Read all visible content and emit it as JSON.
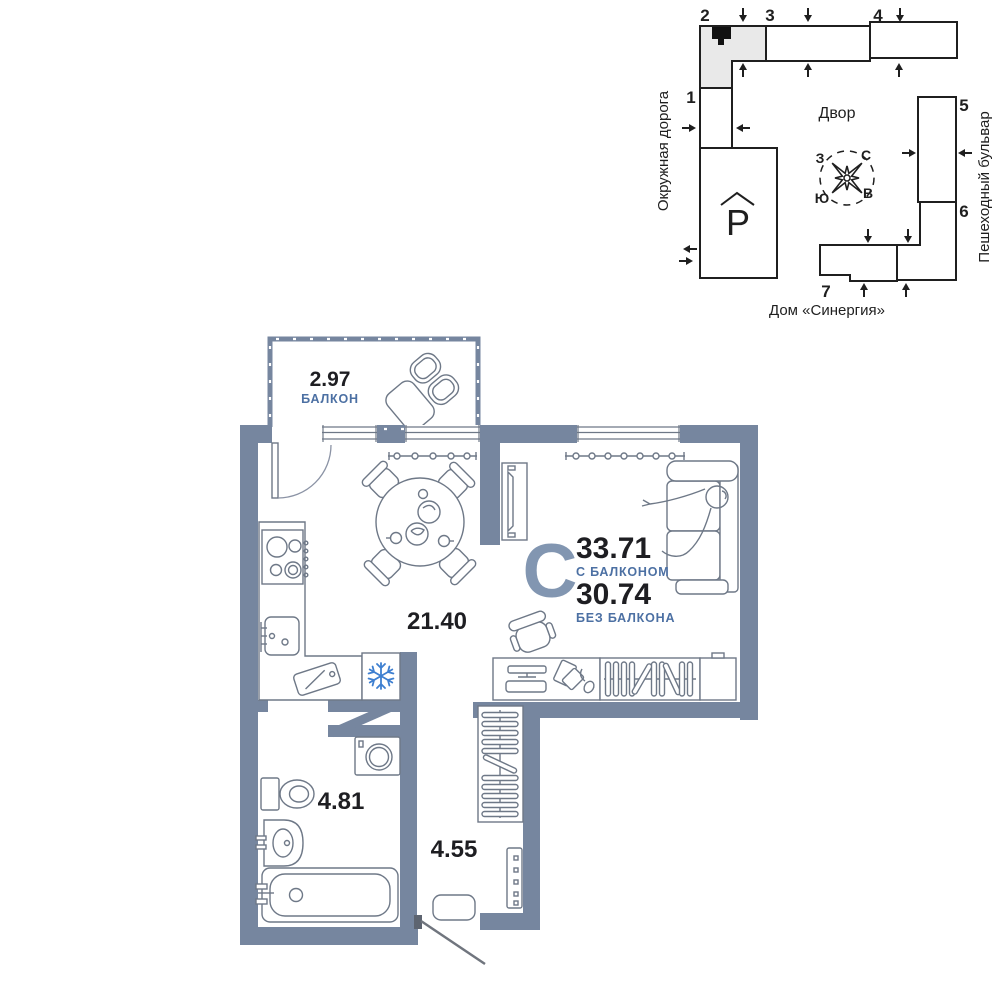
{
  "site_plan": {
    "road_label": "Окружная дорога",
    "boulevard_label": "Пешеходный бульвар",
    "courtyard_label": "Двор",
    "house_name": "Дом «Синергия»",
    "parking_symbol": "P",
    "building_numbers": [
      "1",
      "2",
      "3",
      "4",
      "5",
      "6",
      "7"
    ],
    "compass": {
      "north": "С",
      "east": "В",
      "south": "Ю",
      "west": "З"
    }
  },
  "apartment": {
    "type_letter": "С",
    "area_with_balcony": "33.71",
    "area_with_balcony_label": "С БАЛКОНОМ",
    "area_without_balcony": "30.74",
    "area_without_balcony_label": "БЕЗ БАЛКОНА",
    "rooms": {
      "balcony": {
        "area": "2.97",
        "label": "БАЛКОН"
      },
      "kitchen_living": {
        "area": "21.40"
      },
      "bathroom": {
        "area": "4.81"
      },
      "hallway": {
        "area": "4.55"
      }
    }
  },
  "colors": {
    "wall": "#76869F",
    "furniture_line": "#6E7887",
    "accent_blue": "#4C70A3",
    "type_letter_blue": "#8296B1",
    "dark_text": "#1E1E22",
    "snowflake_blue": "#3E7FD0",
    "site_outline": "#1F1F1F",
    "highlighted_building_fill": "#E9E9E9",
    "apartment_marker": "#111111"
  }
}
